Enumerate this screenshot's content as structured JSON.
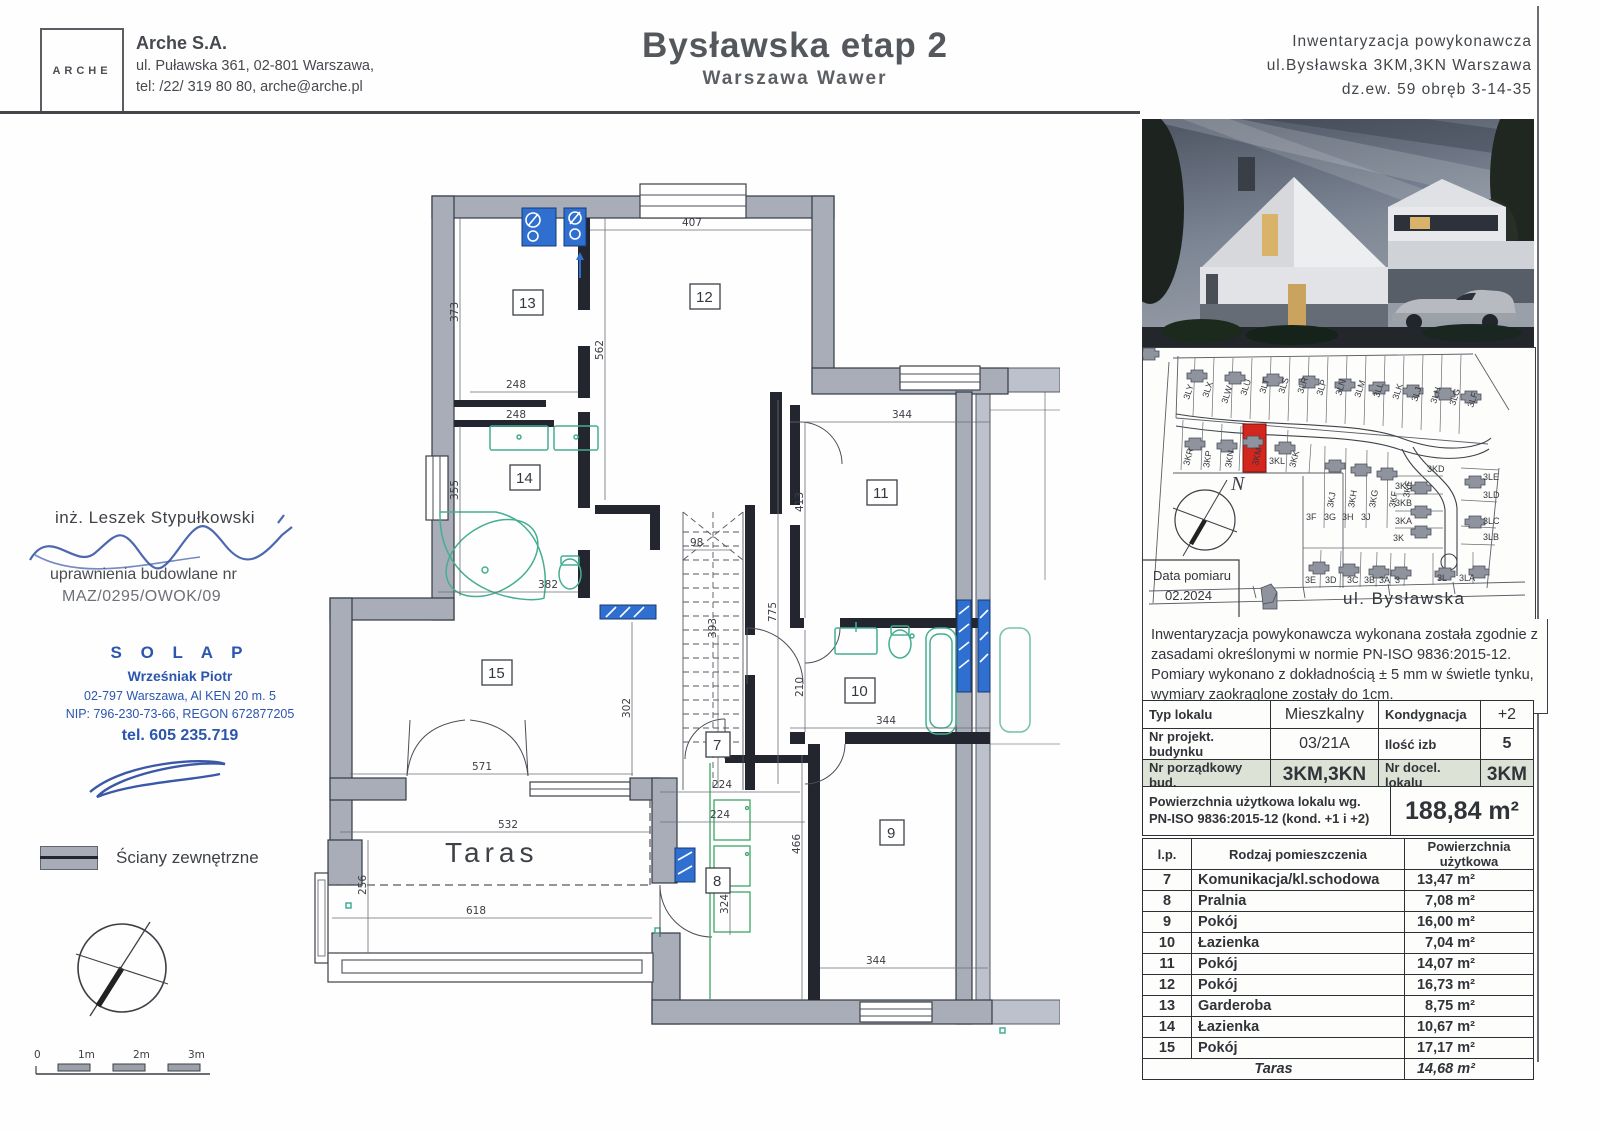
{
  "header": {
    "logo": "ARCHE",
    "company": "Arche S.A.",
    "addr1": "ul. Puławska 361, 02-801 Warszawa,",
    "addr2": "tel: /22/ 319 80 80, arche@arche.pl",
    "title": "Bysławska etap 2",
    "subtitle": "Warszawa Wawer",
    "right1": "Inwentaryzacja powykonawcza",
    "right2": "ul.Bysławska 3KM,3KN Warszawa",
    "right3": "dz.ew. 59 obręb 3-14-35"
  },
  "left": {
    "engineer": "inż. Leszek Stypułkowski",
    "license_label": "uprawnienia budowlane nr",
    "license_no": "MAZ/0295/OWOK/09",
    "stamp": {
      "name": "S O L A P",
      "person": "Wrześniak Piotr",
      "addr": "02-797 Warszawa, Al KEN 20 m. 5",
      "ids": "NIP: 796-230-73-66, REGON 672877205",
      "phone": "tel. 605 235.719"
    },
    "legend_label": "Ściany zewnętrzne",
    "scale_labels": [
      "0",
      "1m",
      "2m",
      "3m"
    ]
  },
  "siteplan": {
    "date_label": "Data pomiaru",
    "date": "02.2024",
    "street": "ul. Bysławska",
    "north": "N",
    "plots_top": [
      "3LY",
      "3LX",
      "3LW",
      "3LU",
      "3LT",
      "3LS",
      "3LR",
      "3LP",
      "3LN",
      "3LM",
      "3LL",
      "3LK",
      "3LJ",
      "3LH",
      "3LG",
      "3LF"
    ],
    "plots_row2": [
      "3KR",
      "3KP",
      "3KN",
      "3KM",
      "3KL",
      "3KK"
    ],
    "plots_mid": [
      "3KJ",
      "3KH",
      "3KG",
      "3KF",
      "3KE",
      "3KD"
    ],
    "plots_k": [
      "3KC",
      "3KB",
      "3KA",
      "3K"
    ],
    "plots_fg": [
      "3F",
      "3G",
      "3H",
      "3J"
    ],
    "plots_right": [
      "3LE",
      "3LD",
      "3LC",
      "3LB"
    ],
    "plots_bottom": [
      "3E",
      "3D",
      "3C",
      "3B",
      "3A",
      "3",
      "3L",
      "3LA"
    ],
    "highlight_color": "#d3261c"
  },
  "note": {
    "text": "Inwentaryzacja powykonawcza wykonana została zgodnie z zasadami określonymi w normie PN-ISO 9836:2015-12. Pomiary wykonano z dokładnością ± 5 mm w świetle tynku, wymiary zaokrąglone zostały do 1cm."
  },
  "info_table": {
    "r1l": "Typ lokalu",
    "r1v": "Mieszkalny",
    "r1l2": "Kondygnacja",
    "r1v2": "+2",
    "r2l": "Nr projekt. budynku",
    "r2v": "03/21A",
    "r2l2": "Ilość izb",
    "r2v2": "5",
    "r3l": "Nr porządkowy bud.",
    "r3v": "3KM,3KN",
    "r3l2": "Nr docel. lokalu",
    "r3v2": "3KM"
  },
  "area_summary": {
    "label1": "Powierzchnia użytkowa lokalu wg.",
    "label2": "PN-ISO 9836:2015-12 (kond. +1 i +2)",
    "value": "188,84 m²"
  },
  "rooms_table": {
    "h_lp": "l.p.",
    "h_name": "Rodzaj pomieszczenia",
    "h_area": "Powierzchnia użytkowa",
    "rows": [
      {
        "lp": "7",
        "name": "Komunikacja/kl.schodowa",
        "area": "13,47 m²"
      },
      {
        "lp": "8",
        "name": "Pralnia",
        "area": "7,08 m²"
      },
      {
        "lp": "9",
        "name": "Pokój",
        "area": "16,00 m²"
      },
      {
        "lp": "10",
        "name": "Łazienka",
        "area": "7,04 m²"
      },
      {
        "lp": "11",
        "name": "Pokój",
        "area": "14,07 m²"
      },
      {
        "lp": "12",
        "name": "Pokój",
        "area": "16,73 m²"
      },
      {
        "lp": "13",
        "name": "Garderoba",
        "area": "8,75 m²"
      },
      {
        "lp": "14",
        "name": "Łazienka",
        "area": "10,67 m²"
      },
      {
        "lp": "15",
        "name": "Pokój",
        "area": "17,17 m²"
      }
    ],
    "taras_name": "Taras",
    "taras_area": "14,68 m²"
  },
  "plan": {
    "taras": "Taras",
    "rooms": [
      "13",
      "12",
      "14",
      "11",
      "10",
      "15",
      "7",
      "8",
      "9"
    ],
    "dims": [
      "407",
      "373",
      "248",
      "248",
      "562",
      "355",
      "382",
      "98",
      "393",
      "775",
      "344",
      "413",
      "210",
      "344",
      "571",
      "302",
      "532",
      "256",
      "618",
      "224",
      "224",
      "466",
      "324",
      "344"
    ],
    "wall_color": "#a8adb8",
    "fixture_color": "#45ae92",
    "shaft_color": "#2f6fd0"
  }
}
